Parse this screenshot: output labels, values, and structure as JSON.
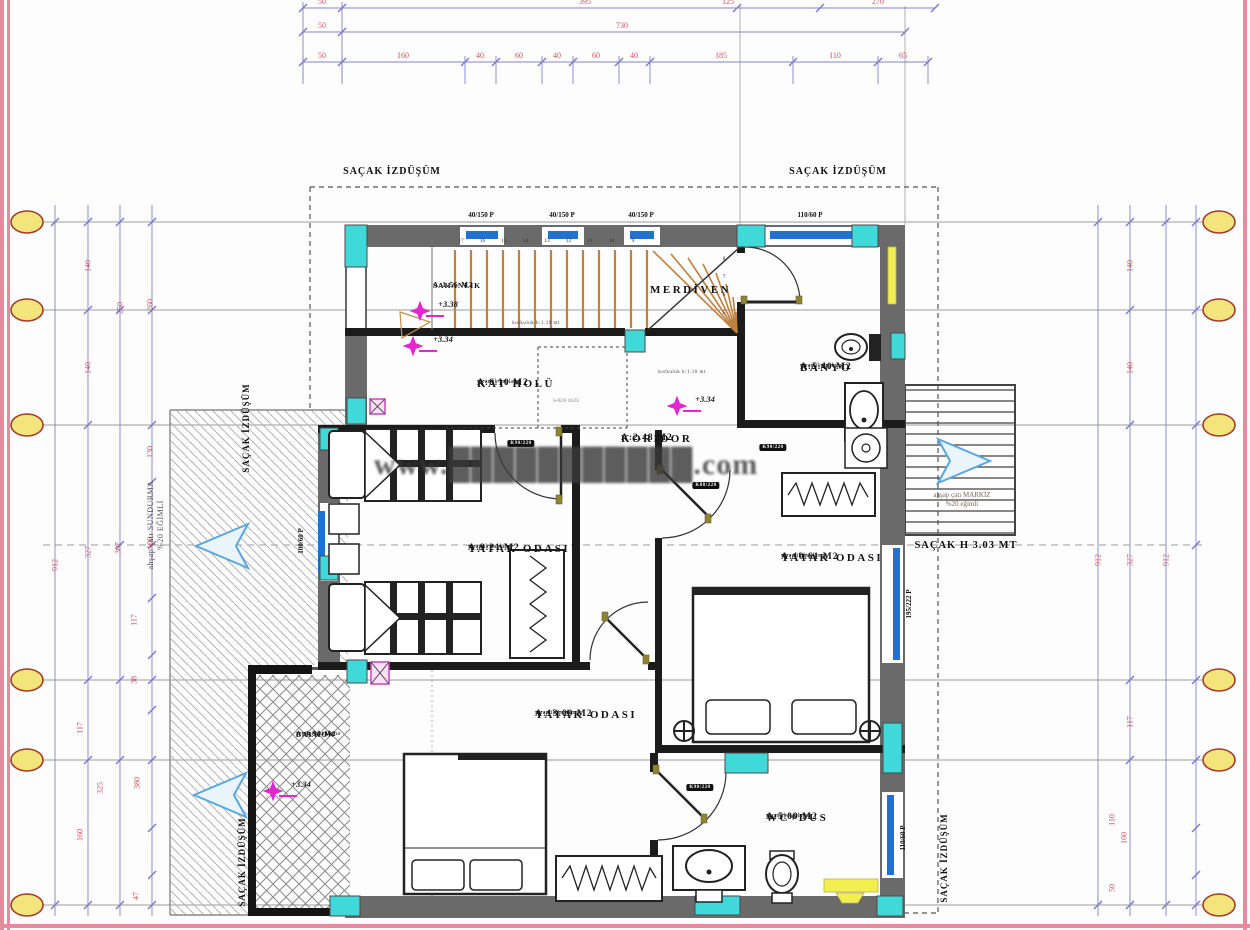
{
  "colors": {
    "column_teal": "#3fd9d9",
    "window_blue": "#1f72d4",
    "stair_wood": "#bf8040",
    "elevation_magenta": "#e326cf",
    "fixture_yellow": "#f2f04f",
    "dimension_text_red": "#d14f62",
    "dimension_line_purple": "#8282cc",
    "grid_gray": "#9a9a9a",
    "axis_bubble_yellow": "#f4e47c",
    "sheet_border_pink": "#e48b9d",
    "arrow_blue": "#5aa7e0"
  },
  "watermark": "www.███████████.com",
  "labels": {
    "sacak_izdusum": "SAÇAK İZDÜŞÜM",
    "sacak_h": "SAÇAK H 3.03 MT",
    "sundurma_line1": "ahşap çatı SUNDURMA",
    "sundurma_line2": "%20 EĞİMLİ",
    "markiz_line1": "ahşap çatı MARKİZ",
    "markiz_line2": "%20 eğimli",
    "korkuluk": "korkuluk h:1.10 mt",
    "stair_section": "S-02/6 16/35"
  },
  "rooms": [
    {
      "id": "sahanlik",
      "name": "SAHANLIK",
      "area": "A:1.56 M2",
      "finish": "",
      "x": 433,
      "y": 281,
      "small": true
    },
    {
      "id": "merdiven",
      "name": "MERDİVEN",
      "area": "",
      "finish": "",
      "x": 650,
      "y": 284,
      "small": false
    },
    {
      "id": "kat-holu",
      "name": "KAT HOLÜ",
      "area": "A:6.10 M2",
      "finish": "seramik kaplama",
      "x": 477,
      "y": 378,
      "small": false
    },
    {
      "id": "koridor",
      "name": "KORİDOR",
      "area": "A:2.48 M2",
      "finish": "",
      "x": 621,
      "y": 433,
      "small": false
    },
    {
      "id": "banyo",
      "name": "BANYO",
      "area": "A:5.40 M2",
      "finish": "seramik kaplama",
      "x": 800,
      "y": 362,
      "small": false
    },
    {
      "id": "yatak-odasi-1",
      "name": "YATAK ODASI",
      "area": "A:9.21 M2",
      "finish": "seramik kaplama",
      "x": 468,
      "y": 543,
      "small": false
    },
    {
      "id": "yatak-odasi-2",
      "name": "YATAK ODASI",
      "area": "A:10.61 M2",
      "finish": "seramik kaplama",
      "x": 781,
      "y": 552,
      "small": false
    },
    {
      "id": "yatak-odasi-3",
      "name": "YATAK ODASI",
      "area": "A:13.09 M2",
      "finish": "seramik kaplama",
      "x": 535,
      "y": 709,
      "small": false
    },
    {
      "id": "wc-dus",
      "name": "WC+DUS",
      "area": "A:5.09 M2",
      "finish": "seramik kaplama",
      "x": 766,
      "y": 812,
      "small": false
    },
    {
      "id": "balkon",
      "name": "BALKON",
      "area": "A:3.90 M2",
      "finish": "seramik kaplama",
      "x": 296,
      "y": 730,
      "small": true
    }
  ],
  "window_labels": [
    {
      "text": "40/150 P",
      "x": 481,
      "y": 211,
      "rot": 0
    },
    {
      "text": "40/150 P",
      "x": 562,
      "y": 211,
      "rot": 0
    },
    {
      "text": "40/150 P",
      "x": 641,
      "y": 211,
      "rot": 0
    },
    {
      "text": "110/60 P",
      "x": 810,
      "y": 211,
      "rot": 0
    },
    {
      "text": "195/222 P",
      "x": 909,
      "y": 604,
      "rot": -90
    },
    {
      "text": "110/60 P",
      "x": 903,
      "y": 838,
      "rot": -90
    },
    {
      "text": "100/60 P",
      "x": 301,
      "y": 541,
      "rot": -90
    }
  ],
  "door_labels": [
    {
      "text": "K90/220",
      "x": 521,
      "y": 440
    },
    {
      "text": "K90/220",
      "x": 773,
      "y": 444
    },
    {
      "text": "K80/220",
      "x": 706,
      "y": 482
    },
    {
      "text": "K90/220",
      "x": 700,
      "y": 784
    }
  ],
  "elevation_markers": [
    {
      "text": "+3.38",
      "x": 448,
      "y": 299
    },
    {
      "text": "+3.34",
      "x": 443,
      "y": 334
    },
    {
      "text": "+3.34",
      "x": 705,
      "y": 394
    },
    {
      "text": "+3.34",
      "x": 301,
      "y": 779
    }
  ],
  "stairs": {
    "top_numbers": [
      "17",
      "16",
      "15",
      "14",
      "13",
      "12",
      "11",
      "10",
      "9"
    ],
    "side_numbers": [
      "8",
      "7",
      "6",
      "5"
    ]
  },
  "dims": {
    "top": [
      {
        "y": 8,
        "items": [
          {
            "t": "50",
            "x": 322
          },
          {
            "t": "395",
            "x": 585
          },
          {
            "t": "125",
            "x": 728
          },
          {
            "t": "270",
            "x": 878
          }
        ]
      },
      {
        "y": 32,
        "items": [
          {
            "t": "50",
            "x": 322
          },
          {
            "t": "730",
            "x": 622
          }
        ]
      },
      {
        "y": 62,
        "items": [
          {
            "t": "50",
            "x": 322
          },
          {
            "t": "160",
            "x": 403
          },
          {
            "t": "40",
            "x": 480
          },
          {
            "t": "60",
            "x": 519
          },
          {
            "t": "40",
            "x": 557
          },
          {
            "t": "60",
            "x": 596
          },
          {
            "t": "40",
            "x": 634
          },
          {
            "t": "185",
            "x": 721
          },
          {
            "t": "110",
            "x": 835
          },
          {
            "t": "65",
            "x": 903
          }
        ]
      }
    ],
    "left": [
      {
        "t": "912",
        "x": 55,
        "y": 565
      },
      {
        "t": "140",
        "x": 88,
        "y": 266
      },
      {
        "t": "140",
        "x": 88,
        "y": 368
      },
      {
        "t": "327",
        "x": 88,
        "y": 552
      },
      {
        "t": "117",
        "x": 80,
        "y": 728
      },
      {
        "t": "160",
        "x": 80,
        "y": 835
      },
      {
        "t": "250",
        "x": 120,
        "y": 308
      },
      {
        "t": "307",
        "x": 118,
        "y": 548
      },
      {
        "t": "325",
        "x": 100,
        "y": 788
      },
      {
        "t": "260",
        "x": 150,
        "y": 305
      },
      {
        "t": "130",
        "x": 150,
        "y": 452
      },
      {
        "t": "100",
        "x": 150,
        "y": 543
      },
      {
        "t": "117",
        "x": 134,
        "y": 620
      },
      {
        "t": "38",
        "x": 134,
        "y": 680
      },
      {
        "t": "380",
        "x": 137,
        "y": 783
      },
      {
        "t": "47",
        "x": 136,
        "y": 896
      }
    ],
    "right": [
      {
        "t": "140",
        "x": 1130,
        "y": 266
      },
      {
        "t": "140",
        "x": 1130,
        "y": 368
      },
      {
        "t": "912",
        "x": 1098,
        "y": 560
      },
      {
        "t": "327",
        "x": 1130,
        "y": 560
      },
      {
        "t": "912",
        "x": 1166,
        "y": 560
      },
      {
        "t": "117",
        "x": 1130,
        "y": 722
      },
      {
        "t": "160",
        "x": 1124,
        "y": 838
      },
      {
        "t": "110",
        "x": 1112,
        "y": 820
      },
      {
        "t": "50",
        "x": 1112,
        "y": 888
      }
    ]
  },
  "axis_bubbles": {
    "left_x": 27,
    "right_x": 1219,
    "rows_y": [
      222,
      310,
      425,
      680,
      760,
      905
    ]
  }
}
